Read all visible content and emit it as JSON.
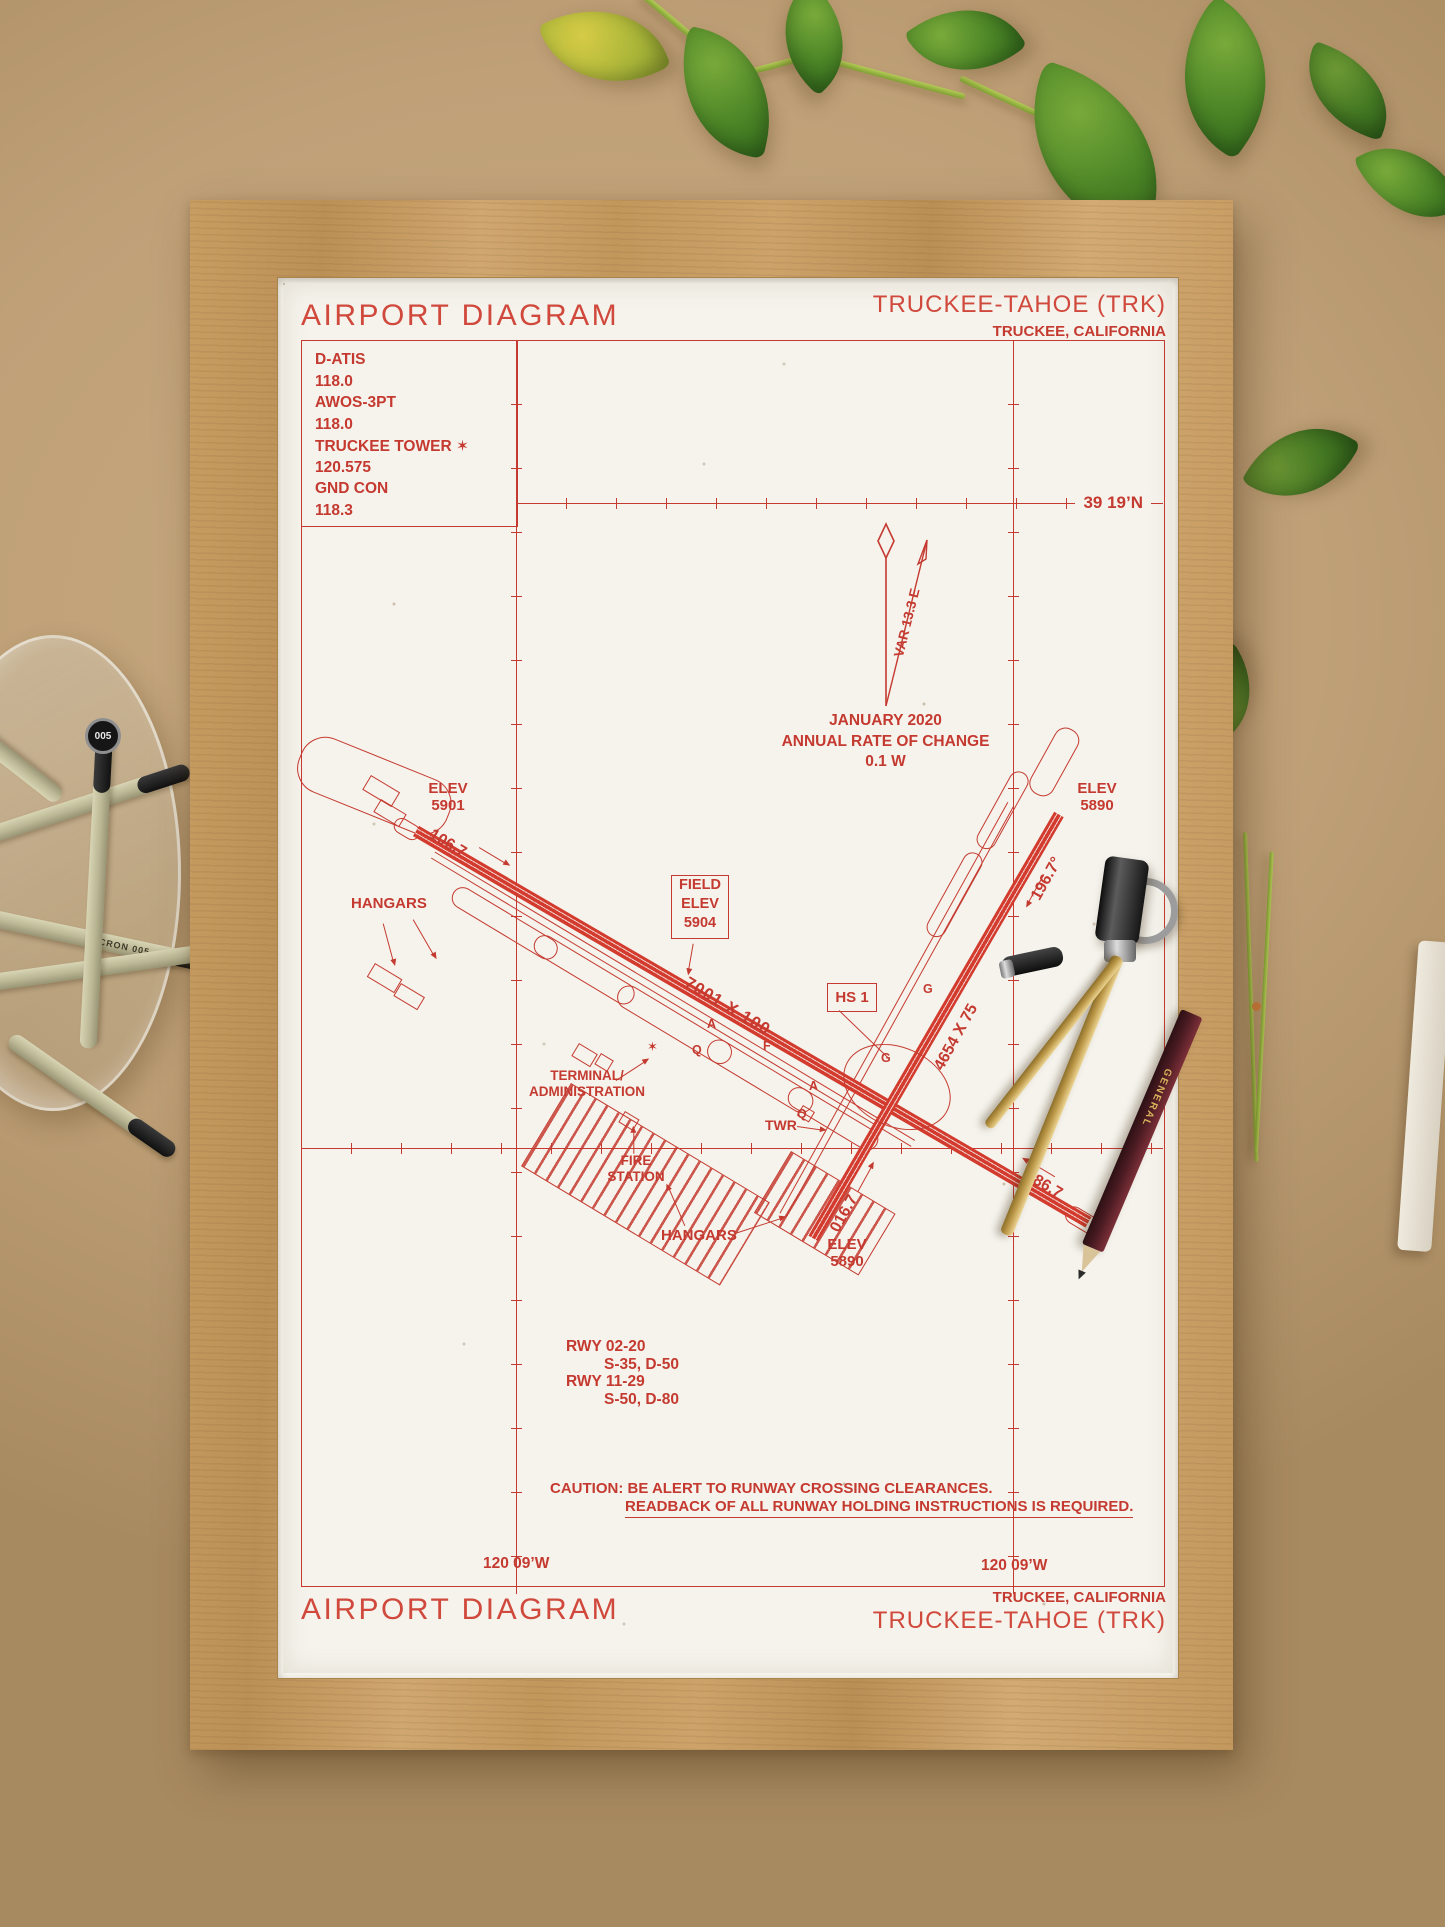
{
  "colors": {
    "ink": "#c53a30",
    "paper": "#f5f3ec",
    "frame_wood": "#c69c62",
    "board": "#bfa077"
  },
  "poster": {
    "top": {
      "title": "AIRPORT DIAGRAM",
      "airport": "TRUCKEE-TAHOE (TRK)",
      "city": "TRUCKEE, CALIFORNIA"
    },
    "comm": {
      "lines": [
        "D-ATIS",
        "118.0",
        "AWOS-3PT",
        "118.0",
        "TRUCKEE TOWER ✶",
        "120.575",
        "GND CON",
        "118.3"
      ]
    },
    "geo": {
      "lat": "39 19’N",
      "lon_left": "120 09’W",
      "lon_right": "120 09’W"
    },
    "compass": {
      "var_label": "VAR 13.3  E",
      "jan": "JANUARY 2020",
      "rate": "ANNUAL RATE OF CHANGE",
      "rate_val": "0.1  W"
    },
    "runway_main": {
      "dim": "7001 X 100",
      "hdg_nw": "106.7",
      "hdg_se": "286.7"
    },
    "runway_cross": {
      "dim": "4654 X 75",
      "hdg_n": "196.7°",
      "hdg_s": "016.7"
    },
    "elev": {
      "nw_l1": "ELEV",
      "nw_l2": "5901",
      "ne_l1": "ELEV",
      "ne_l2": "5890",
      "s_l1": "ELEV",
      "s_l2": "5890"
    },
    "field_elev": {
      "l1": "FIELD",
      "l2": "ELEV",
      "l3": "5904"
    },
    "hotspot": "HS 1",
    "labels": {
      "hangars_left": "HANGARS",
      "hangars_bottom": "HANGARS",
      "terminal_l1": "TERMINAL/",
      "terminal_l2": "ADMINISTRATION",
      "fire_l1": "FIRE",
      "fire_l2": "STATION",
      "twr": "TWR",
      "beacon": "✶"
    },
    "taxi": [
      "A",
      "Q",
      "F",
      "G",
      "G",
      "Q",
      "A"
    ],
    "rwy_info": [
      "RWY 02-20",
      "S-35, D-50",
      "RWY 11-29",
      "S-50, D-80"
    ],
    "caution": {
      "l1": "CAUTION: BE ALERT TO RUNWAY CROSSING CLEARANCES.",
      "l2": "READBACK OF ALL RUNWAY HOLDING INSTRUCTIONS IS REQUIRED."
    },
    "bottom": {
      "city": "TRUCKEE, CALIFORNIA",
      "airport": "TRUCKEE-TAHOE (TRK)",
      "title": "AIRPORT DIAGRAM"
    }
  },
  "props": {
    "pen_cap": "005",
    "pen_body": "MICRON 005",
    "pencil_brand": "GENERAL"
  }
}
